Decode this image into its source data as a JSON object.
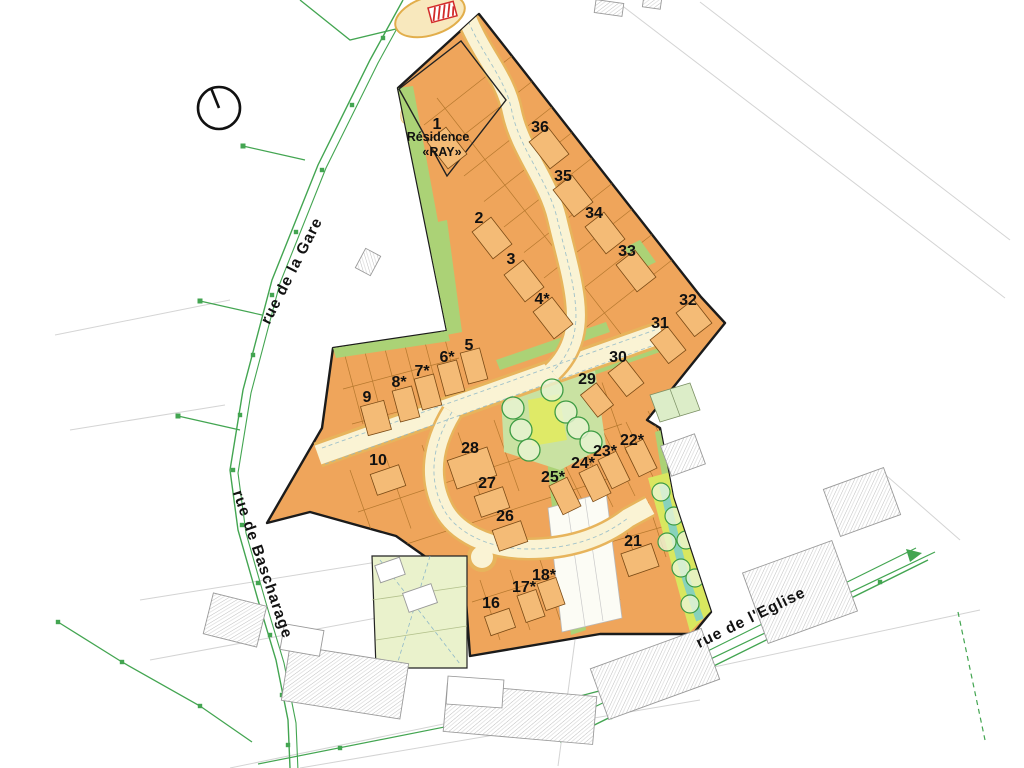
{
  "map": {
    "residence": {
      "name_line1": "Résidence",
      "name_line2": "«RAY»",
      "x": 438,
      "y": 141
    },
    "lots": [
      {
        "label": "1",
        "x": 437,
        "y": 129
      },
      {
        "label": "36",
        "x": 540,
        "y": 132
      },
      {
        "label": "35",
        "x": 563,
        "y": 181
      },
      {
        "label": "2",
        "x": 479,
        "y": 223
      },
      {
        "label": "34",
        "x": 594,
        "y": 218
      },
      {
        "label": "33",
        "x": 627,
        "y": 256
      },
      {
        "label": "3",
        "x": 511,
        "y": 264
      },
      {
        "label": "4*",
        "x": 542,
        "y": 304
      },
      {
        "label": "32",
        "x": 688,
        "y": 305
      },
      {
        "label": "31",
        "x": 660,
        "y": 328
      },
      {
        "label": "5",
        "x": 469,
        "y": 350
      },
      {
        "label": "6*",
        "x": 447,
        "y": 362
      },
      {
        "label": "30",
        "x": 618,
        "y": 362
      },
      {
        "label": "7*",
        "x": 422,
        "y": 376
      },
      {
        "label": "29",
        "x": 587,
        "y": 384
      },
      {
        "label": "8*",
        "x": 399,
        "y": 387
      },
      {
        "label": "9",
        "x": 367,
        "y": 402
      },
      {
        "label": "22*",
        "x": 632,
        "y": 445
      },
      {
        "label": "28",
        "x": 470,
        "y": 453
      },
      {
        "label": "23*",
        "x": 605,
        "y": 456
      },
      {
        "label": "10",
        "x": 378,
        "y": 465
      },
      {
        "label": "24*",
        "x": 583,
        "y": 468
      },
      {
        "label": "25*",
        "x": 553,
        "y": 482
      },
      {
        "label": "27",
        "x": 487,
        "y": 488
      },
      {
        "label": "26",
        "x": 505,
        "y": 521
      },
      {
        "label": "21",
        "x": 633,
        "y": 546
      },
      {
        "label": "18*",
        "x": 544,
        "y": 580
      },
      {
        "label": "17*",
        "x": 524,
        "y": 592
      },
      {
        "label": "16",
        "x": 491,
        "y": 608
      }
    ],
    "streets": [
      {
        "name": "rue de la Gare",
        "x": 296,
        "y": 273,
        "rotation": -63
      },
      {
        "name": "rue de Bascharage",
        "x": 258,
        "y": 566,
        "rotation": 71
      },
      {
        "name": "rue de l'Eglise",
        "x": 753,
        "y": 622,
        "rotation": -26
      }
    ],
    "colors": {
      "lot_fill": "#EFA55B",
      "building_fill": "#F4BB76",
      "boundary": "#1b1b1b",
      "green_strip": "#ABD276",
      "park_green": "#C9E2A2",
      "lime": "#DFEA67",
      "road_fill": "#FAF3D4",
      "road_edge": "#E7B45C",
      "stream_teal": "#7ECFC6",
      "stream_lime": "#D9E75F",
      "street_line": "#43A551",
      "pale_block": "#EAF2CC",
      "ne_parcels": "#DCEDC8",
      "marker_red": "#D22B2B"
    }
  }
}
